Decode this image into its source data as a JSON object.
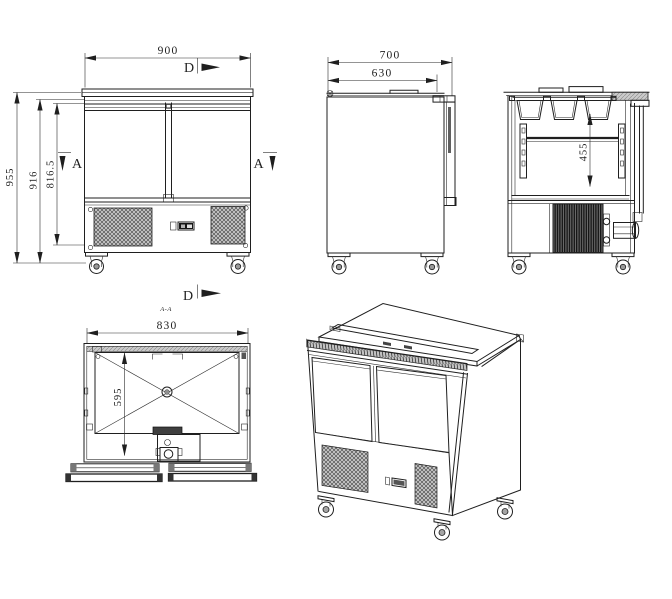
{
  "colors": {
    "ink": "#1f1f1f",
    "bg": "#ffffff",
    "grille_fill": "#c8c8c8",
    "condenser_fill": "#5a5a5a",
    "band_fill": "#cbcbcb"
  },
  "front_view": {
    "dim_width": "900",
    "dim_height_overall": "955",
    "dim_height_916": "916",
    "dim_height_816_5": "816.5",
    "marker_d_top": "D",
    "marker_a_left": "A",
    "marker_a_right": "A"
  },
  "side_view": {
    "dim_depth": "700",
    "dim_depth_630": "630"
  },
  "rear_section_view": {
    "dim_455": "455"
  },
  "plan_view": {
    "marker_d_bottom": "D",
    "section_label": "A-A",
    "dim_width": "830",
    "dim_depth": "595"
  }
}
